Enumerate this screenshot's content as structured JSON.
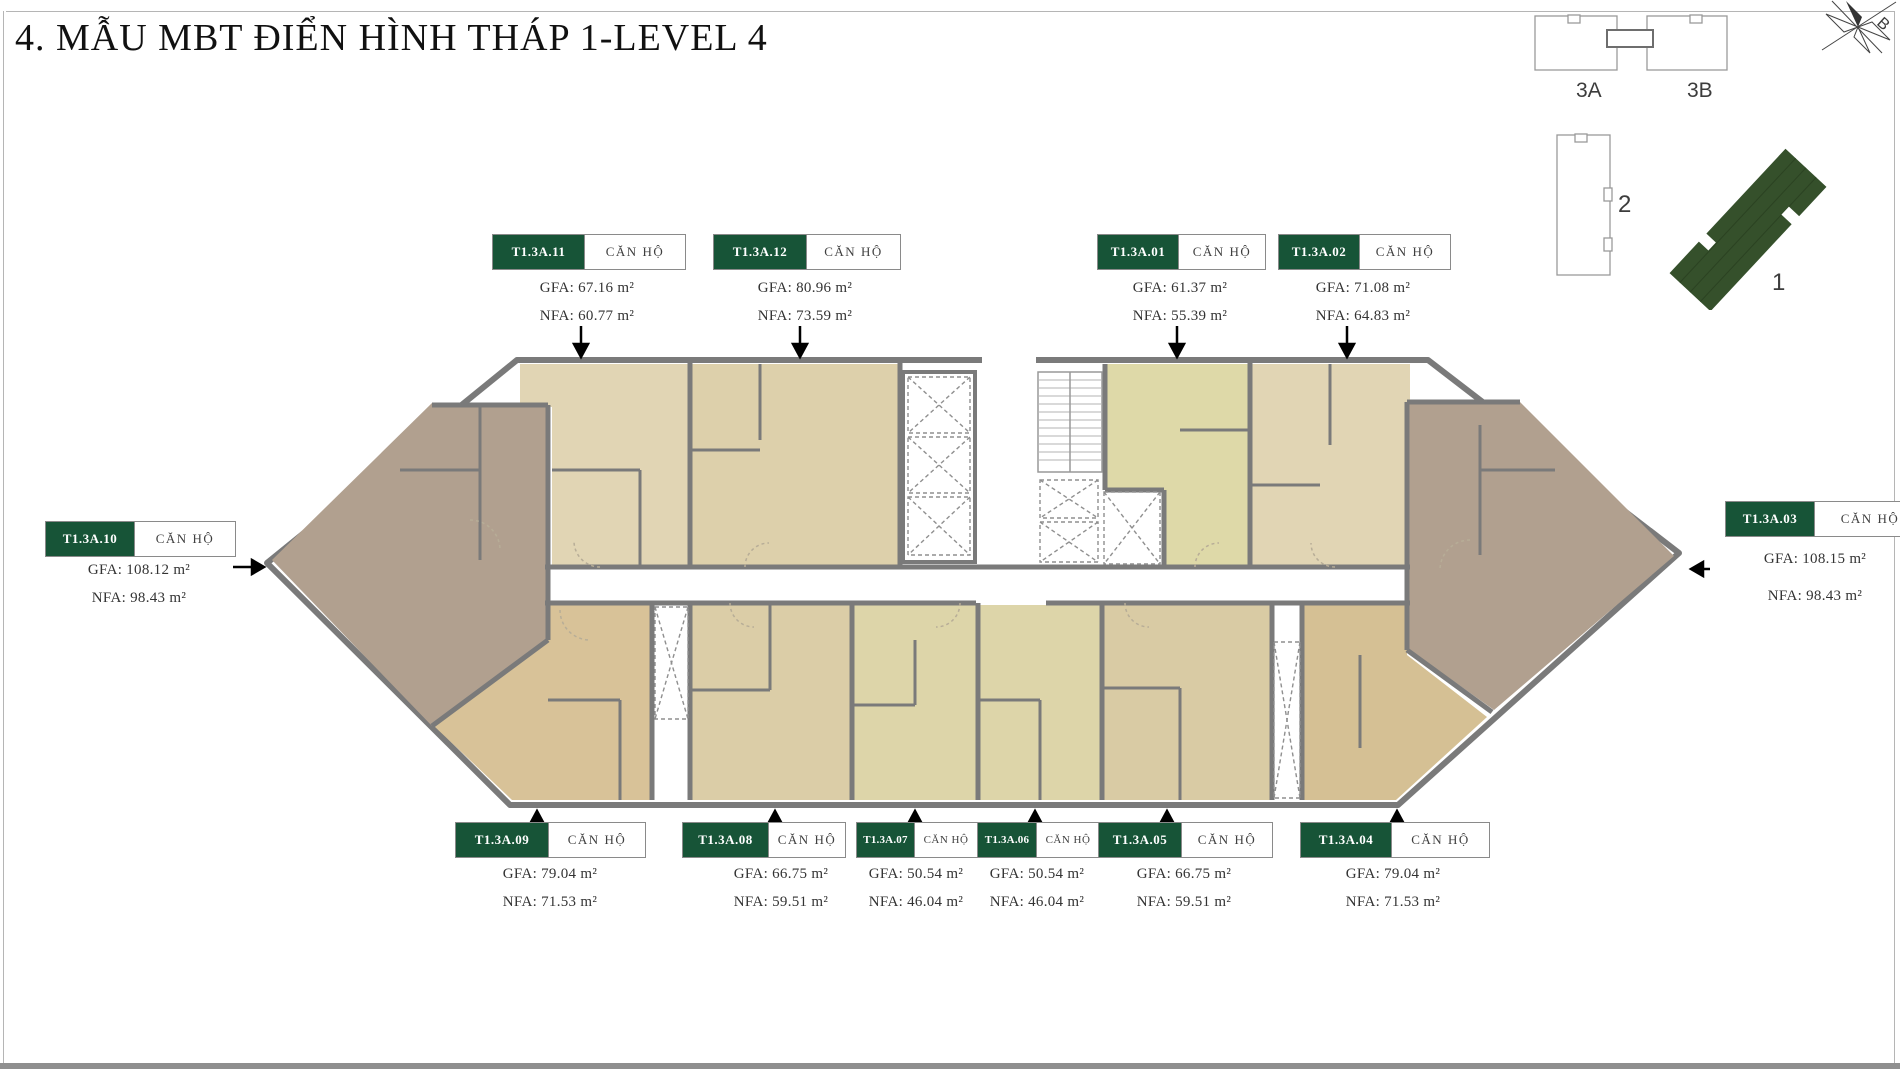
{
  "title": "4. MẪU MBT ĐIỂN HÌNH THÁP 1-LEVEL 4",
  "unit_type_label": "CĂN HỘ",
  "key_plan": {
    "block_3a": "3A",
    "block_3b": "3B",
    "block_2": "2",
    "block_1": "1",
    "north_label": "B"
  },
  "colors": {
    "badge_green": "#175437",
    "keyplan_tower_green": "#35502b",
    "wall_gray": "#7a7a7a",
    "brown_unit": "#b1a08f",
    "beige_unit": "#e1d5b4",
    "khaki_unit": "#ded9a8",
    "sand_unit": "#d8c298"
  },
  "units": {
    "u01": {
      "id": "T1.3A.01",
      "gfa": "GFA: 61.37 m²",
      "nfa": "NFA: 55.39 m²",
      "color": "#ded9a8"
    },
    "u02": {
      "id": "T1.3A.02",
      "gfa": "GFA: 71.08 m²",
      "nfa": "NFA: 64.83 m²",
      "color": "#e1d5b4"
    },
    "u03": {
      "id": "T1.3A.03",
      "gfa": "GFA: 108.15 m²",
      "nfa": "NFA: 98.43 m²",
      "color": "#b1a08f"
    },
    "u04": {
      "id": "T1.3A.04",
      "gfa": "GFA: 79.04 m²",
      "nfa": "NFA: 71.53 m²",
      "color": "#d5c094"
    },
    "u05": {
      "id": "T1.3A.05",
      "gfa": "GFA: 66.75 m²",
      "nfa": "NFA: 59.51 m²",
      "color": "#d9cba4"
    },
    "u06": {
      "id": "T1.3A.06",
      "gfa": "GFA: 50.54 m²",
      "nfa": "NFA: 46.04 m²",
      "color": "#ddd5a9"
    },
    "u07": {
      "id": "T1.3A.07",
      "gfa": "GFA: 50.54 m²",
      "nfa": "NFA: 46.04 m²",
      "color": "#ddd5a9"
    },
    "u08": {
      "id": "T1.3A.08",
      "gfa": "GFA: 66.75 m²",
      "nfa": "NFA: 59.51 m²",
      "color": "#dbcda7"
    },
    "u09": {
      "id": "T1.3A.09",
      "gfa": "GFA: 79.04 m²",
      "nfa": "NFA: 71.53 m²",
      "color": "#d8c298"
    },
    "u10": {
      "id": "T1.3A.10",
      "gfa": "GFA: 108.12 m²",
      "nfa": "NFA: 98.43 m²",
      "color": "#b1a08f"
    },
    "u11": {
      "id": "T1.3A.11",
      "gfa": "GFA: 67.16 m²",
      "nfa": "NFA: 60.77 m²",
      "color": "#e1d5b4"
    },
    "u12": {
      "id": "T1.3A.12",
      "gfa": "GFA: 80.96 m²",
      "nfa": "NFA: 73.59 m²",
      "color": "#ddd0ab"
    }
  }
}
